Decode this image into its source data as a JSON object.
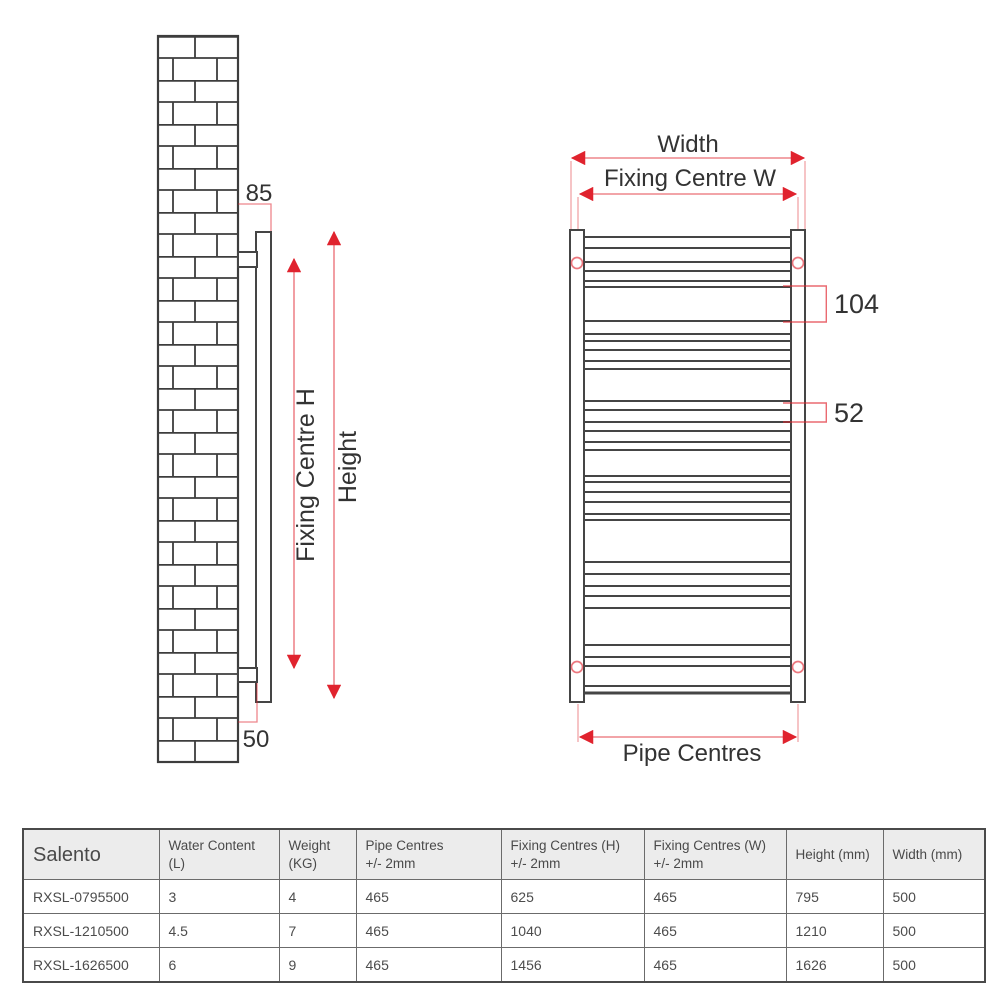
{
  "colors": {
    "accent_red": "#e0232e",
    "diagram_line": "#454545",
    "table_border": "#6b6b6b",
    "table_header_bg": "#ececec",
    "diagram_text": "#333333",
    "table_text": "#4c4c4c"
  },
  "side_view": {
    "labels": {
      "wall_offset_top": "85",
      "wall_offset_bottom": "50",
      "fixing_centre_h": "Fixing Centre H",
      "height": "Height"
    }
  },
  "front_view": {
    "labels": {
      "width": "Width",
      "fixing_centre_w": "Fixing Centre W",
      "pipe_centres": "Pipe Centres",
      "rung_gap_large": "104",
      "rung_gap_small": "52"
    },
    "rung_offsets": [
      7,
      18,
      32,
      41,
      51,
      57,
      91,
      104,
      111,
      120,
      131,
      139,
      171,
      180,
      192,
      201,
      212,
      220,
      246,
      252,
      262,
      272,
      284,
      290,
      332,
      344,
      356,
      366,
      378,
      415,
      427,
      436,
      456,
      463
    ]
  },
  "table": {
    "headers": [
      {
        "line1": "Salento",
        "line2": ""
      },
      {
        "line1": "Water Content",
        "line2": "(L)"
      },
      {
        "line1": "Weight",
        "line2": "(KG)"
      },
      {
        "line1": "Pipe Centres",
        "line2": "+/- 2mm"
      },
      {
        "line1": "Fixing Centres (H)",
        "line2": "+/- 2mm"
      },
      {
        "line1": "Fixing Centres (W)",
        "line2": "+/- 2mm"
      },
      {
        "line1": "Height (mm)",
        "line2": ""
      },
      {
        "line1": "Width (mm)",
        "line2": ""
      }
    ],
    "rows": [
      [
        "RXSL-0795500",
        "3",
        "4",
        "465",
        "625",
        "465",
        "795",
        "500"
      ],
      [
        "RXSL-1210500",
        "4.5",
        "7",
        "465",
        "1040",
        "465",
        "1210",
        "500"
      ],
      [
        "RXSL-1626500",
        "6",
        "9",
        "465",
        "1456",
        "465",
        "1626",
        "500"
      ]
    ]
  }
}
